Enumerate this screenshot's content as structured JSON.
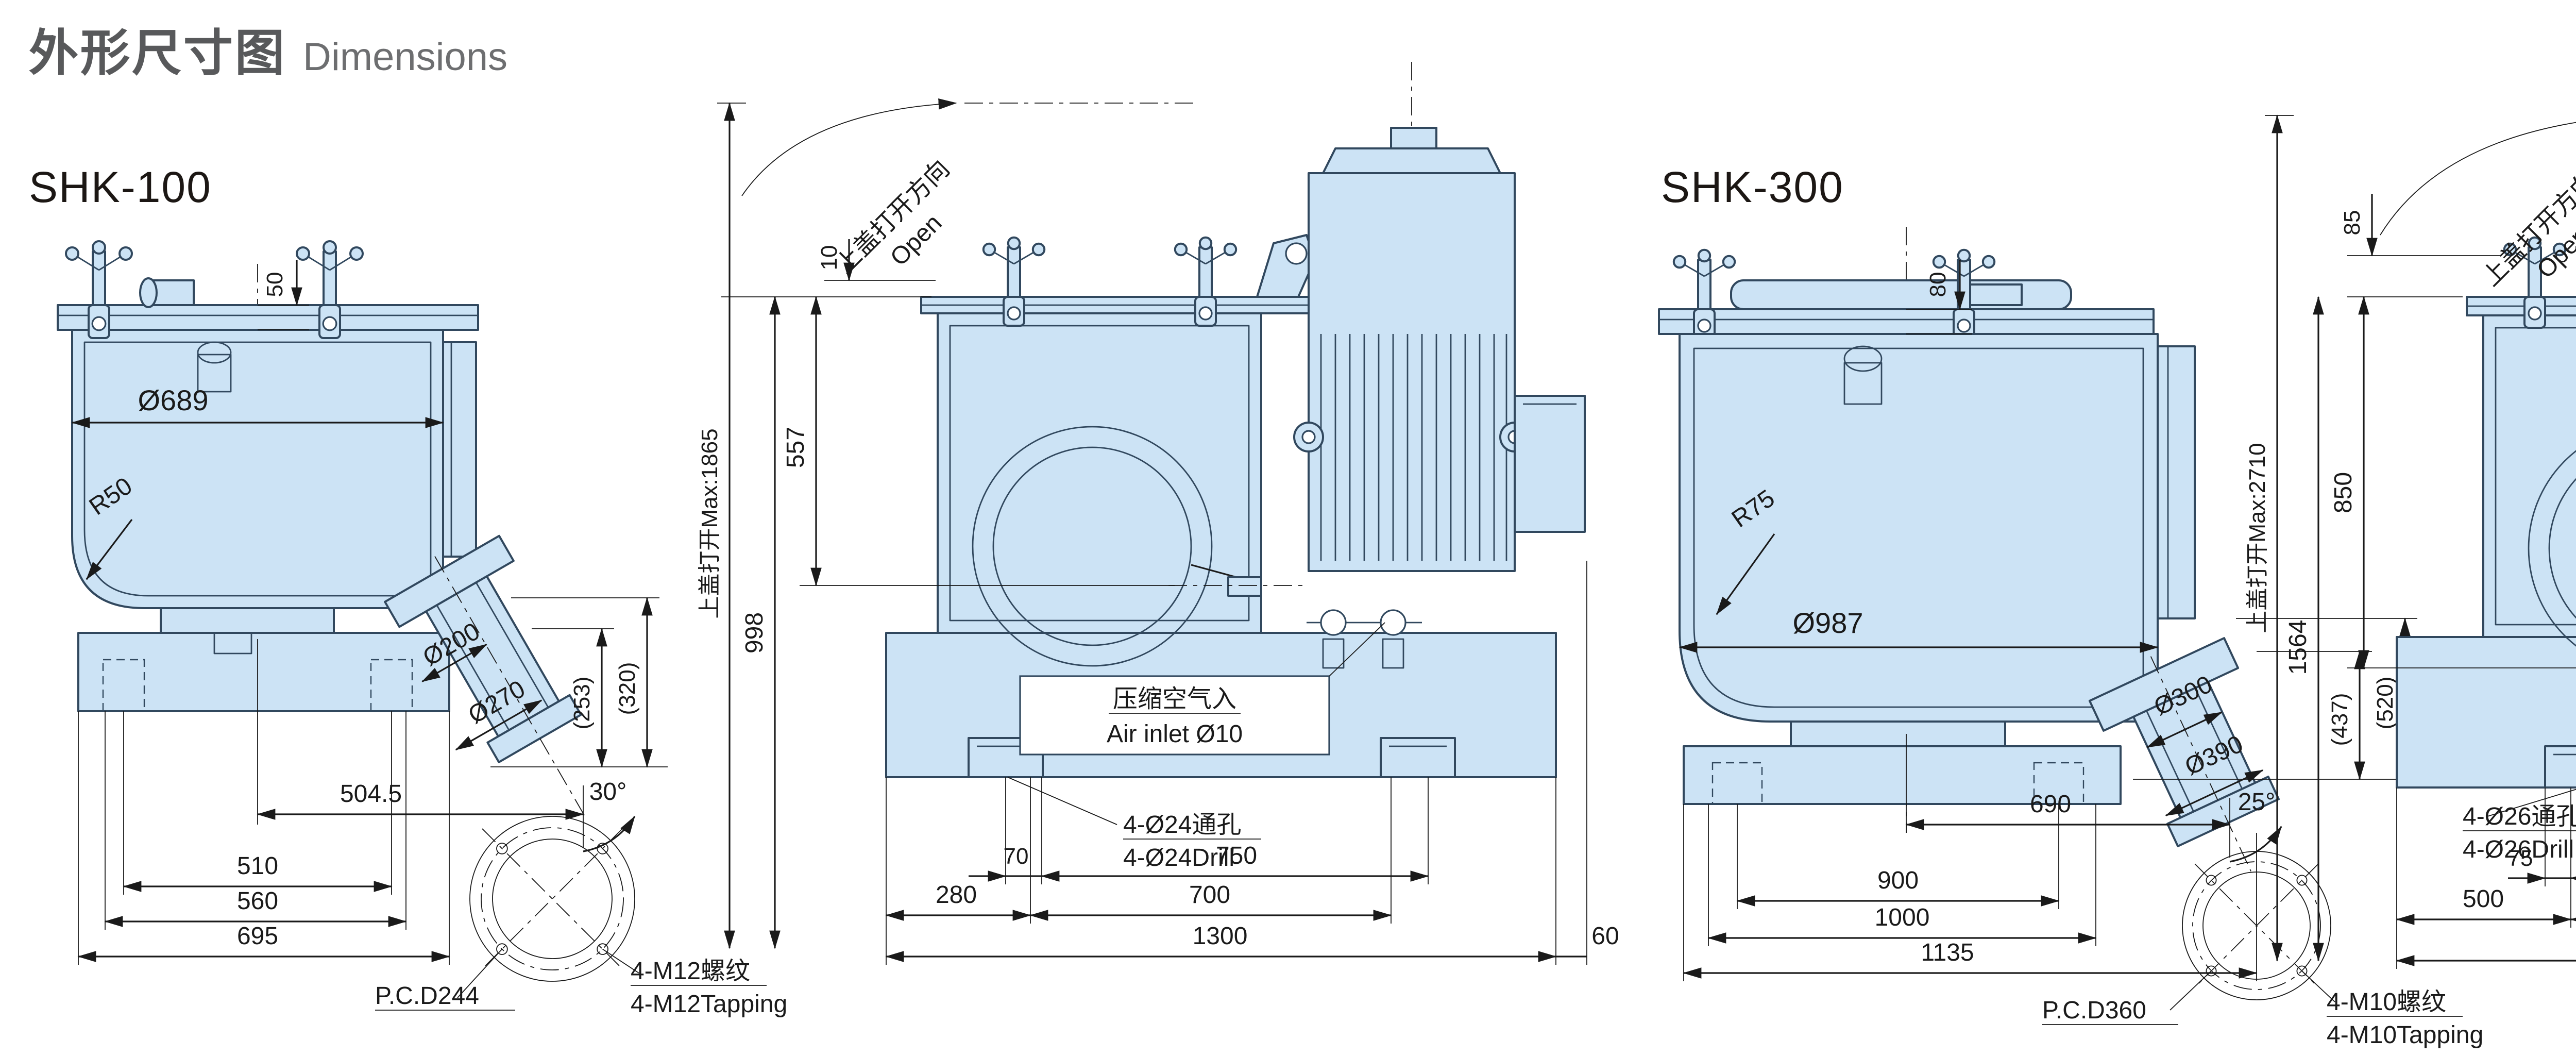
{
  "page": {
    "title_zh": "外形尺寸图",
    "title_en": "Dimensions"
  },
  "colors": {
    "machine_fill": "#cce3f5",
    "machine_stroke": "#31485e",
    "dim_color": "#1a1a1a",
    "title_zh_color": "#58595b",
    "title_en_color": "#6d6e70",
    "model_label_color": "#1c1714",
    "background": "#ffffff"
  },
  "shk100": {
    "model": "SHK-100",
    "front": {
      "lid_gap": "50",
      "vessel_dia": "Ø689",
      "corner_r": "R50",
      "chute_dia_inner": "Ø200",
      "chute_dia_outer": "Ø270",
      "chute_drop_inner": "(253)",
      "chute_drop_outer": "(320)",
      "chute_angle": "30°",
      "chute_offset": "504.5",
      "bolt_span": "510",
      "base_width": "560",
      "overall_width": "695",
      "pcd": "P.C.D244",
      "tap_zh": "4-M12螺纹",
      "tap_en": "4-M12Tapping"
    },
    "side": {
      "open_zh": "上盖打开方向",
      "open_en": "Open",
      "open_max": "上盖打开Max:1865",
      "lid_lift": "10",
      "rim_height": "557",
      "body_height": "998",
      "air_zh": "压缩空气入",
      "air_en": "Air inlet Ø10",
      "drill_zh": "4-Ø24通孔",
      "drill_en": "4-Ø24Drill",
      "foot_width": "70",
      "hole_span": "750",
      "front_offset": "280",
      "foot_span": "700",
      "overall_length": "1300",
      "rear_gap": "60"
    }
  },
  "shk300": {
    "model": "SHK-300",
    "front": {
      "lid_gap": "80",
      "vessel_dia": "Ø987",
      "corner_r": "R75",
      "chute_dia_inner": "Ø300",
      "chute_dia_outer": "Ø390",
      "chute_drop_inner": "(437)",
      "chute_drop_outer": "(520)",
      "chute_angle": "25°",
      "chute_offset": "690",
      "bolt_span": "900",
      "base_width": "1000",
      "overall_width": "1135",
      "pcd": "P.C.D360",
      "tap_zh": "4-M10螺纹",
      "tap_en": "4-M10Tapping"
    },
    "side": {
      "open_zh": "上盖打开方向",
      "open_en": "Open",
      "open_max": "上盖打开Max:2710",
      "lid_lift": "85",
      "rim_height": "850",
      "body_height": "1564",
      "air_zh": "压缩空气入",
      "air_en": "Air inletØ10",
      "drill_zh": "4-Ø26通孔",
      "drill_en": "4-Ø26Drill",
      "foot_width": "75",
      "hole_span": "1200",
      "front_offset": "500",
      "foot_span": "1090",
      "overall_length": "2150",
      "rear_gap": "60"
    }
  }
}
